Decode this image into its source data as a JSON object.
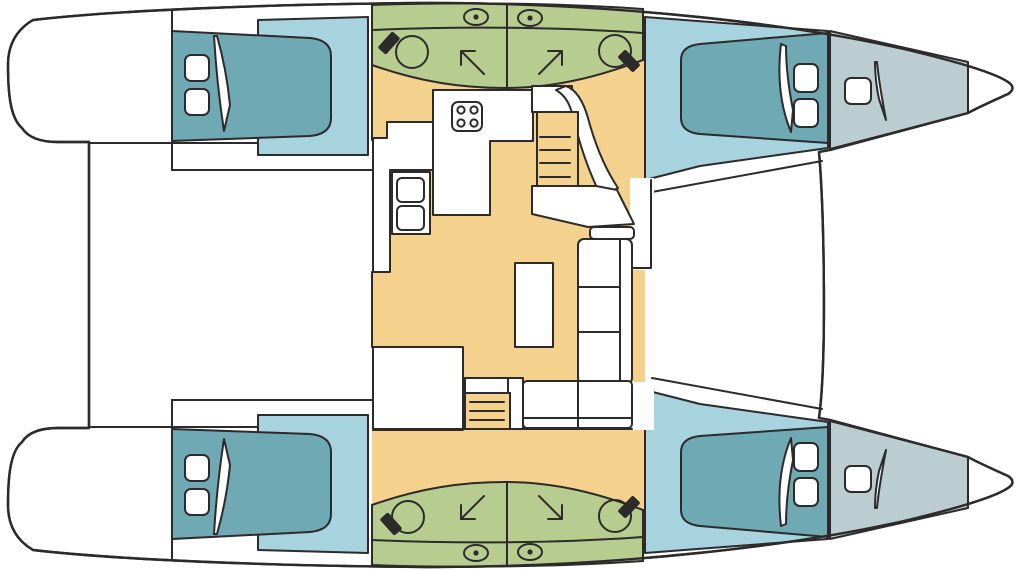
{
  "document": {
    "kind": "catamaran-deck-plan",
    "orientation": {
      "bow": "right",
      "stern": "left"
    }
  },
  "colors": {
    "background": "#ffffff",
    "white": "#ffffff",
    "outline": "#2d2a2b",
    "bed": "#6fa9b4",
    "cabin_floor": "#a7d3de",
    "forepeak": "#bccdd2",
    "bathroom": "#b7cd90",
    "salon": "#f4d18c"
  },
  "areas": {
    "cockpit": {
      "position": "aft-center",
      "features": []
    },
    "salon": {
      "position": "center",
      "features": [
        "galley-counter",
        "stove-4-burners",
        "fridge-cabinet",
        "chart-desk",
        "coffee-table",
        "l-shaped-sofa",
        "companionway-stairs-port",
        "companionway-stairs-starboard",
        "aft-door-opening"
      ]
    },
    "bathrooms": {
      "count": 4,
      "position": "amidships in each hull, two compartments per hull",
      "features_per_compartment": [
        "washbasin",
        "faucet",
        "shower-direction-arrow",
        "porthole"
      ]
    },
    "cabins": {
      "count": 4,
      "positions": [
        "port-aft",
        "port-forward",
        "starboard-aft",
        "starboard-forward"
      ],
      "features_per_cabin": [
        "double-bed",
        "pillow",
        "pillow",
        "folded-blanket"
      ]
    },
    "forepeaks": {
      "count": 2,
      "features_per_forepeak": [
        "deck-hatch",
        "folded-sail"
      ]
    },
    "foredeck": {
      "position": "forward-center",
      "features": [
        "front-crossbeam",
        "trampoline-area"
      ]
    },
    "sterns": {
      "count": 2,
      "features": [
        "swim-platform"
      ]
    }
  },
  "counts": {
    "hulls": 2,
    "beds": 4,
    "pillows": 8,
    "washbasins": 4,
    "portholes": 4,
    "shower_arrows": 4,
    "stair_flights": 2,
    "stove_burners": 4,
    "deck_hatches": 2
  }
}
